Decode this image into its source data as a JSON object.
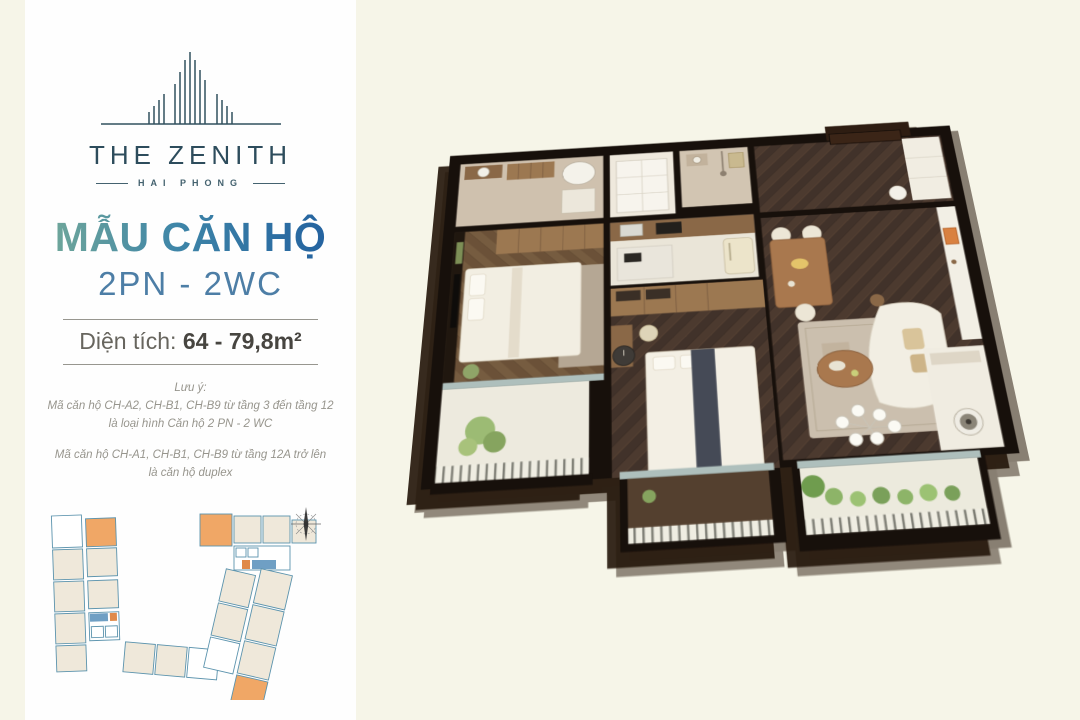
{
  "page": {
    "background": "#f6f5e8"
  },
  "card": {
    "logo": {
      "name": "THE ZENITH",
      "location": "HAI PHONG"
    },
    "headline": "MẪU CĂN HỘ",
    "subheadline": "2PN - 2WC",
    "area": {
      "label": "Diện tích:",
      "value": "64 - 79,8m²"
    },
    "notes": {
      "heading": "Lưu ý:",
      "p1_line1": "Mã căn hộ CH-A2, CH-B1, CH-B9 từ tầng 3 đến tầng 12",
      "p1_line2": "là loại hình Căn hộ 2 PN - 2 WC",
      "p2_line1": "Mã căn hộ CH-A1, CH-B1, CH-B9 từ tầng 12A trở lên",
      "p2_line2": "là căn hộ duplex"
    }
  },
  "site_plan": {
    "highlighted_units": 3,
    "highlight_color": "#f0a766",
    "unit_fill": "#efe8da",
    "outline_color": "#5b93ad",
    "compass": "compass-rose-icon"
  },
  "render": {
    "type": "3d-isometric-floor-plan",
    "rooms": [
      "entry-hall",
      "kitchen",
      "dining-area",
      "living-room",
      "master-bedroom",
      "bedroom-2",
      "bathroom-1",
      "bathroom-2",
      "laundry-wc",
      "master-balcony",
      "bedroom-balcony",
      "living-balcony"
    ]
  },
  "brand_colors": {
    "navy": "#2d4c5c",
    "gradient_start": "#79ad97",
    "gradient_end": "#1f5c9e",
    "steel_blue": "#4d7ea6"
  }
}
